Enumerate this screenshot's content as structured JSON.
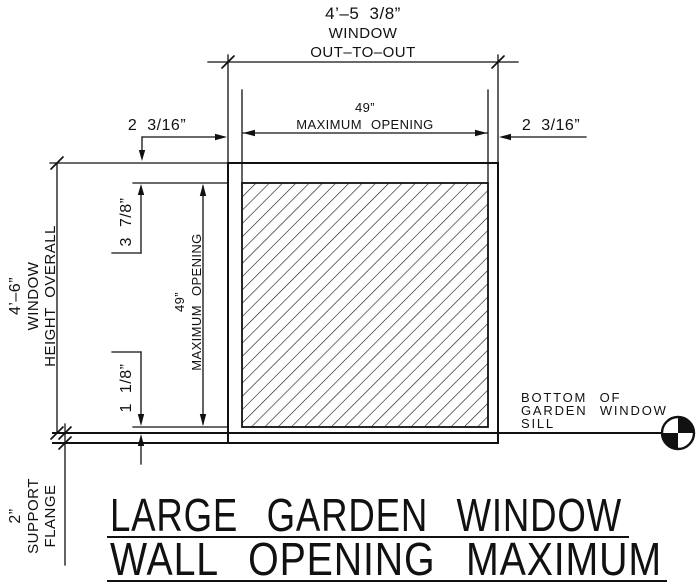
{
  "colors": {
    "ink": "#111111",
    "paper": "#ffffff"
  },
  "header_dimension": {
    "value": "4’–5 3/8”",
    "line2": "WINDOW",
    "line3": "OUT–TO–OUT"
  },
  "width_dims": {
    "left_offset": "2 3/16”",
    "opening_value": "49”",
    "opening_label": "MAXIMUM OPENING",
    "right_offset": "2 3/16”"
  },
  "height_dims": {
    "overall_value": "4’–6”",
    "overall_line2": "WINDOW",
    "overall_line3": "HEIGHT OVERALL",
    "top_inset": "3 7/8”",
    "opening_value": "49”",
    "opening_label": "MAXIMUM OPENING",
    "bottom_inset": "1 1/8”"
  },
  "flange": {
    "value": "2”",
    "line2": "SUPPORT",
    "line3": "FLANGE"
  },
  "sill_note": {
    "line1": "BOTTOM  OF",
    "line2": "GARDEN  WINDOW",
    "line3": "SILL"
  },
  "title": {
    "line1": "LARGE GARDEN WINDOW",
    "line2": "WALL OPENING MAXIMUM"
  }
}
